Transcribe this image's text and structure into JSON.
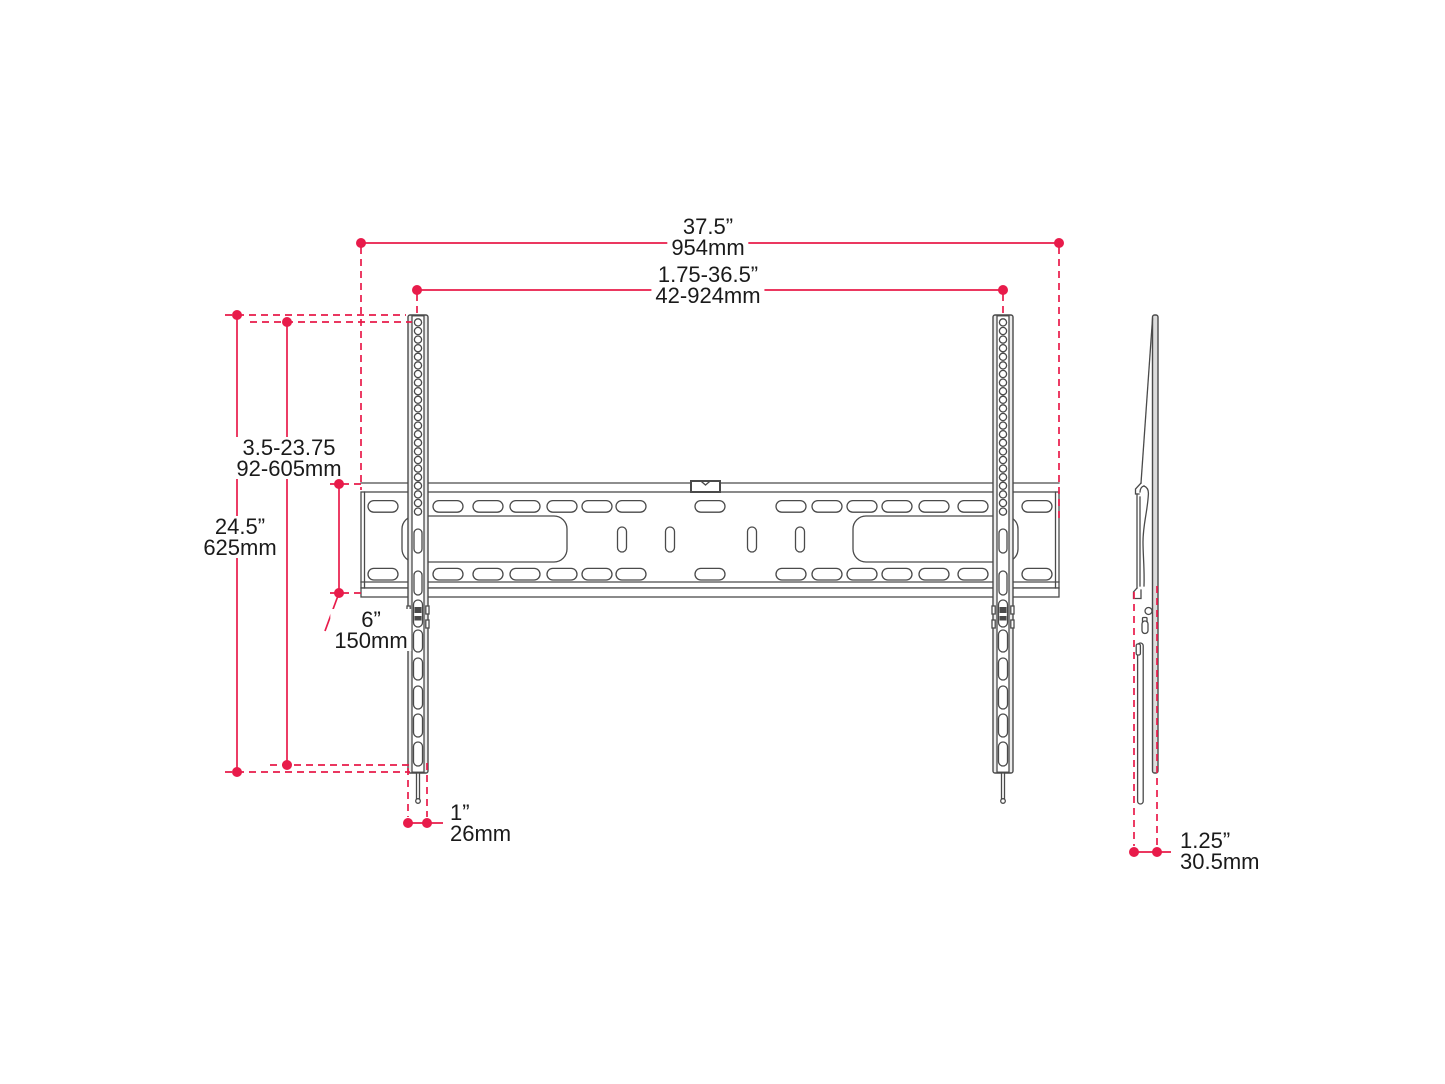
{
  "drawing": {
    "type": "technical-dimension-diagram",
    "subject": "TV wall mount bracket - front view and side view with dimensions",
    "colors": {
      "accent": "#e81b4a",
      "line": "#4a4a4a",
      "text": "#1a1a1a"
    },
    "dimensions": {
      "width_total": {
        "in": "37.5”",
        "mm": "954mm"
      },
      "width_range": {
        "in": "1.75-36.5”",
        "mm": "42-924mm"
      },
      "height_range": {
        "in": "3.5-23.75",
        "mm": "92-605mm"
      },
      "height_total": {
        "in": "24.5”",
        "mm": "625mm"
      },
      "plate_height": {
        "in": "6”",
        "mm": "150mm"
      },
      "pin_offset": {
        "in": "1”",
        "mm": "26mm"
      },
      "depth": {
        "in": "1.25”",
        "mm": "30.5mm"
      }
    }
  }
}
